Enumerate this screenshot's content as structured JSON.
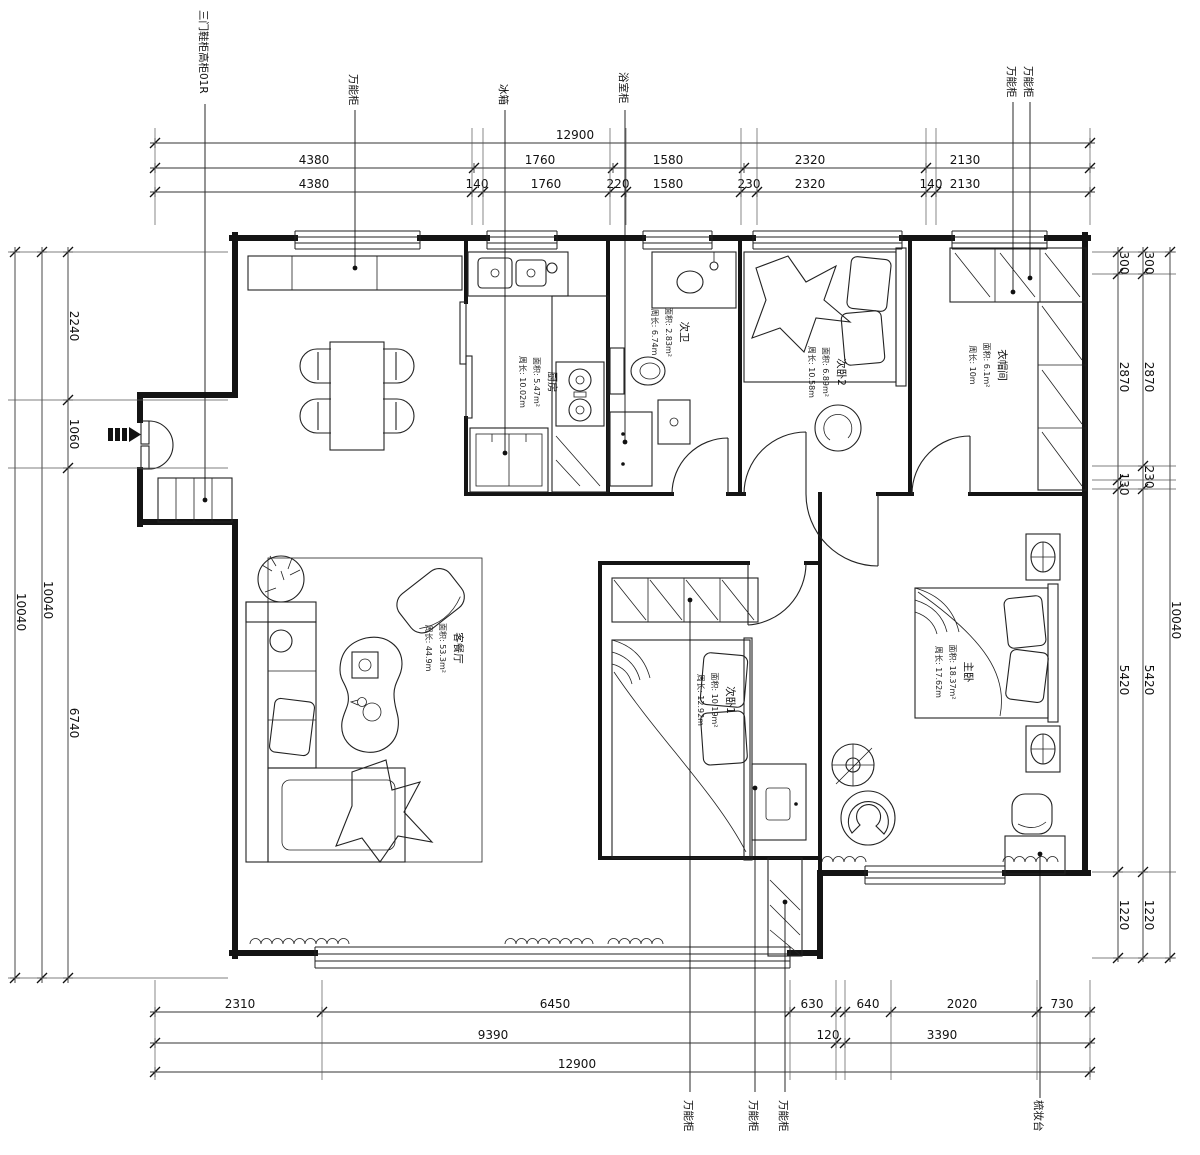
{
  "drawing_type": "apartment-floor-plan",
  "rooms": [
    {
      "name": "厨房",
      "area": "面积: 5.47m²",
      "perimeter": "周长: 10.02m"
    },
    {
      "name": "次卫",
      "area": "面积: 2.83m²",
      "perimeter": "周长: 6.74m"
    },
    {
      "name": "次卧2",
      "area": "面积: 6.89m²",
      "perimeter": "周长: 10.58m"
    },
    {
      "name": "衣帽间",
      "area": "面积: 6.1m²",
      "perimeter": "周长: 10m"
    },
    {
      "name": "客餐厅",
      "area": "面积: 53.3m²",
      "perimeter": "周长: 44.9m"
    },
    {
      "name": "次卧1",
      "area": "面积: 10.19m²",
      "perimeter": "周长: 12.92m"
    },
    {
      "name": "主卧",
      "area": "面积: 18.37m²",
      "perimeter": "周长: 17.62m"
    }
  ],
  "callouts_top": [
    "三门鞋柜高柜01R",
    "万能柜",
    "冰箱",
    "浴室柜",
    "万能柜",
    "万能柜"
  ],
  "callouts_bottom": [
    "万能柜",
    "万能柜",
    "万能柜",
    "梳妆台"
  ],
  "dimensions": {
    "top_row1": [
      "12900"
    ],
    "top_row2": [
      "4380",
      "1760",
      "1580",
      "2320",
      "2130"
    ],
    "top_row3": [
      "4380",
      "140",
      "1760",
      "220",
      "1580",
      "230",
      "2320",
      "140",
      "2130"
    ],
    "bottom_row1": [
      "2310",
      "6450",
      "630",
      "640",
      "2020",
      "730"
    ],
    "bottom_row2": [
      "9390",
      "120",
      "3390"
    ],
    "bottom_row3": [
      "12900"
    ],
    "left_inner": [
      "2240",
      "1060",
      "6740"
    ],
    "left_middle": [
      "10040"
    ],
    "left_outer": [
      "10040"
    ],
    "right_inner": [
      "300",
      "2870",
      "130",
      "5420",
      "1220"
    ],
    "right_middle": [
      "300",
      "2870",
      "230",
      "5420",
      "1220"
    ],
    "right_outer": [
      "10040"
    ]
  },
  "line_color": "#141414",
  "background_color": "#ffffff"
}
